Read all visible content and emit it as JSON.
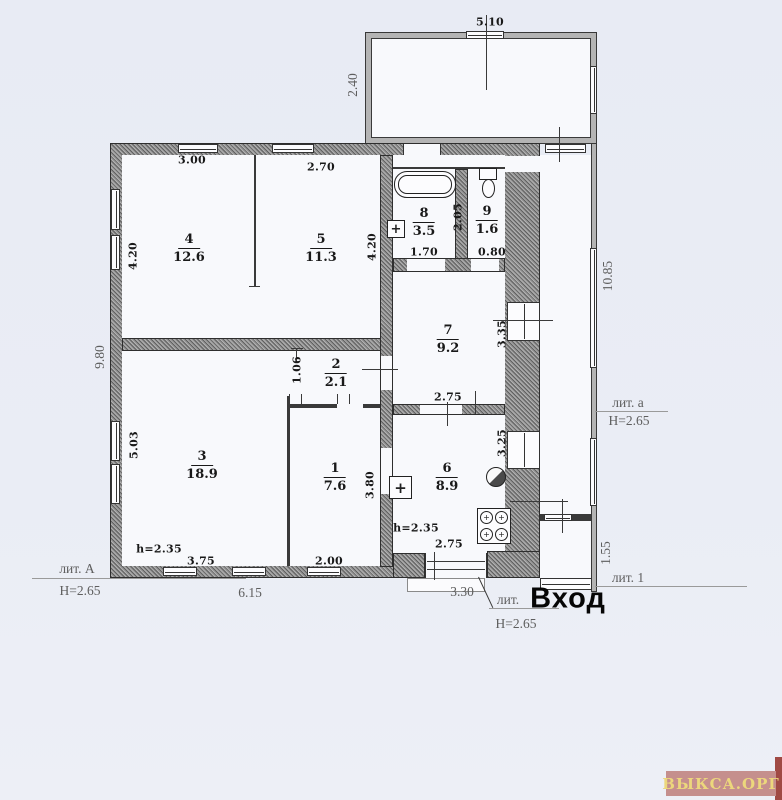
{
  "doc_type": "floor-plan-scan",
  "rooms": [
    {
      "num": "4",
      "area": "12.6"
    },
    {
      "num": "5",
      "area": "11.3"
    },
    {
      "num": "8",
      "area": "3.5"
    },
    {
      "num": "9",
      "area": "1.6"
    },
    {
      "num": "7",
      "area": "9.2"
    },
    {
      "num": "2",
      "area": "2.1"
    },
    {
      "num": "3",
      "area": "18.9"
    },
    {
      "num": "1",
      "area": "7.6"
    },
    {
      "num": "6",
      "area": "8.9"
    }
  ],
  "dims": {
    "top_width": "5.10",
    "top_depth": "2.40",
    "left_height": "9.80",
    "right_height": "10.85",
    "r4_w": "3.00",
    "r4_h": "4.20",
    "r5_w": "2.70",
    "r5_h": "4.20",
    "r8_h": "2.05",
    "r8_w": "1.70",
    "r9_w": "0.80",
    "r7_h": "3.35",
    "r7_w": "2.75",
    "r2_door": "1.06",
    "r3_h": "5.03",
    "r3_w": "3.75",
    "r1_h": "3.80",
    "r1_w": "2.00",
    "r6_h": "3.25",
    "r6_w": "2.75",
    "bottom_total": "6.15",
    "entry_width": "3.30",
    "porch_height": "1.55"
  },
  "labels": {
    "lit_A": "лит. А",
    "H_A": "Н=2.65",
    "lit_a": "лит. а",
    "H_a": "Н=2.65",
    "lit_1": "лит. 1",
    "lit_entry": "лит.",
    "entry": "Вход",
    "H_entry": "Н=2.65",
    "h_left": "h=2.35",
    "h_right": "h=2.35"
  },
  "watermark": {
    "text": "ВЫКСА.ОРГ",
    "bg_color": "#c58f8d",
    "text_color": "#ecd77c",
    "edge_color": "#a04a44"
  }
}
